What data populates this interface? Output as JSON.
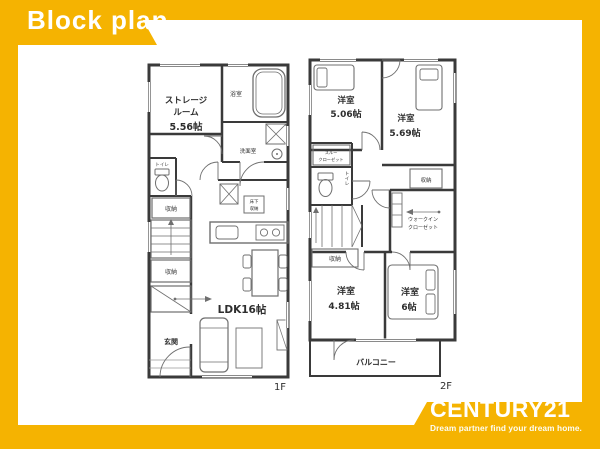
{
  "colors": {
    "brand_yellow": "#F5B301",
    "wall": "#3A3A3A"
  },
  "header": {
    "title": "Block plan"
  },
  "footer": {
    "brand": "CENTURY21",
    "tagline": "Dream partner find your dream home."
  },
  "floor1": {
    "label": "1F",
    "storage_line1": "ストレージ",
    "storage_line2": "ルーム",
    "storage_size": "5.56帖",
    "bath": "浴室",
    "washroom": "洗面室",
    "toilet": "トイレ",
    "closet_a": "収納",
    "closet_b": "収納",
    "underfloor_line1": "床下",
    "underfloor_line2": "収納",
    "ldk": "LDK16帖",
    "entrance": "玄関"
  },
  "floor2": {
    "label": "2F",
    "bedroom1_name": "洋室",
    "bedroom1_size": "5.06帖",
    "bedroom2_name": "洋室",
    "bedroom2_size": "5.69帖",
    "bedroom3_name": "洋室",
    "bedroom3_size": "4.81帖",
    "bedroom4_name": "洋室",
    "bedroom4_size": "6帖",
    "toilet": "トイレ",
    "hall_closet_line1": "スルー",
    "hall_closet_line2": "クローゼット",
    "stair_closet": "収納",
    "bedroom2_closet": "収納",
    "wic_line1": "ウォークイン",
    "wic_line2": "クローゼット",
    "balcony": "バルコニー"
  }
}
